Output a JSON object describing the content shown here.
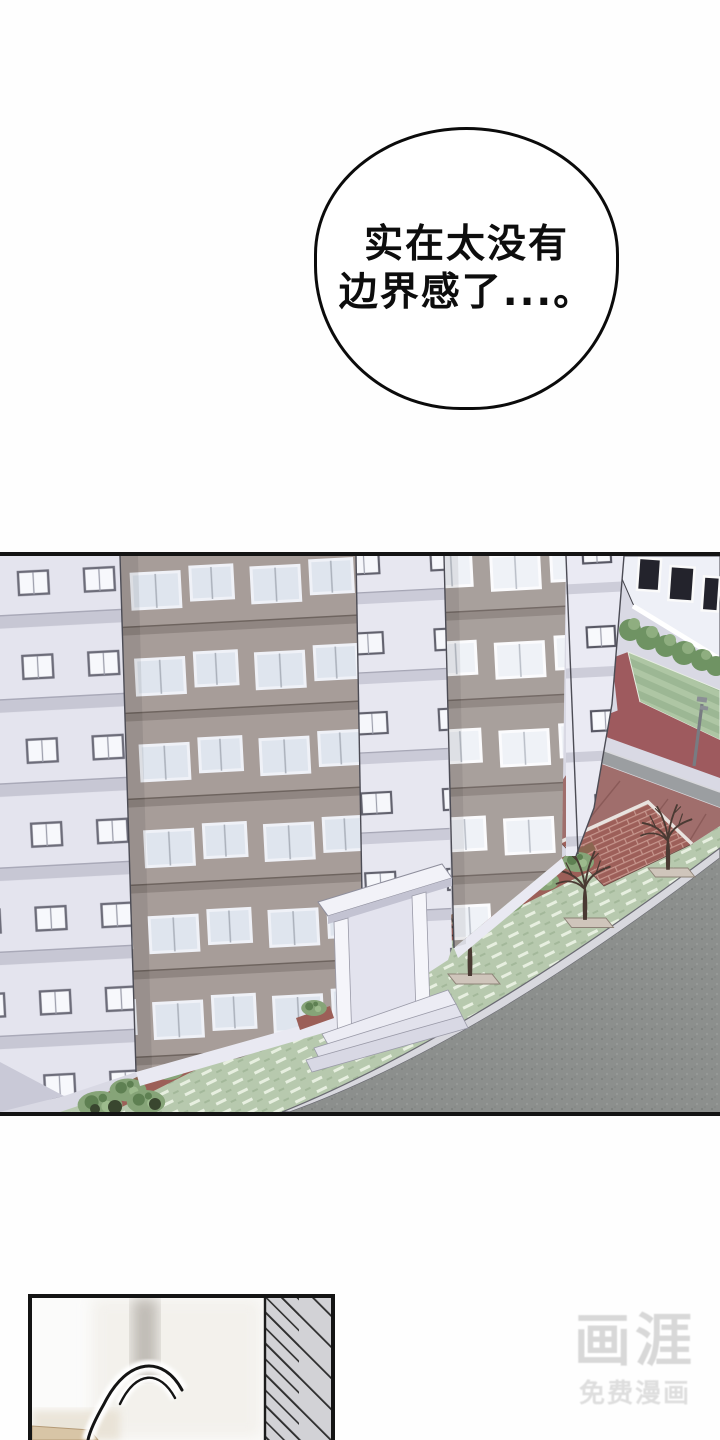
{
  "speech_bubble": {
    "line1": "实在太没有",
    "line2": "边界感了...。"
  },
  "watermark": {
    "logo": "画涯",
    "subtitle": "免费漫画"
  },
  "colors": {
    "panel_border": "#141414",
    "bubble_border": "#0b0b0b",
    "facade_light_lavender": "#e4e4ee",
    "facade_taupe": "#a79d99",
    "facade_taupe_right": "#a8a09c",
    "street_asphalt": "#8c8f8d",
    "curb": "#d8d8de",
    "sidewalk_green": "#b7c9ae",
    "court_green": "#9cb794",
    "track_red": "#9e5a5e",
    "pavement_red": "#a06e6c",
    "brick_wall": "#9d5f59",
    "bush_green": "#86a478",
    "hedge_green": "#6f9363",
    "tree_trunk": "#4a3a33",
    "watermark_gray": "#d8d8d8"
  }
}
